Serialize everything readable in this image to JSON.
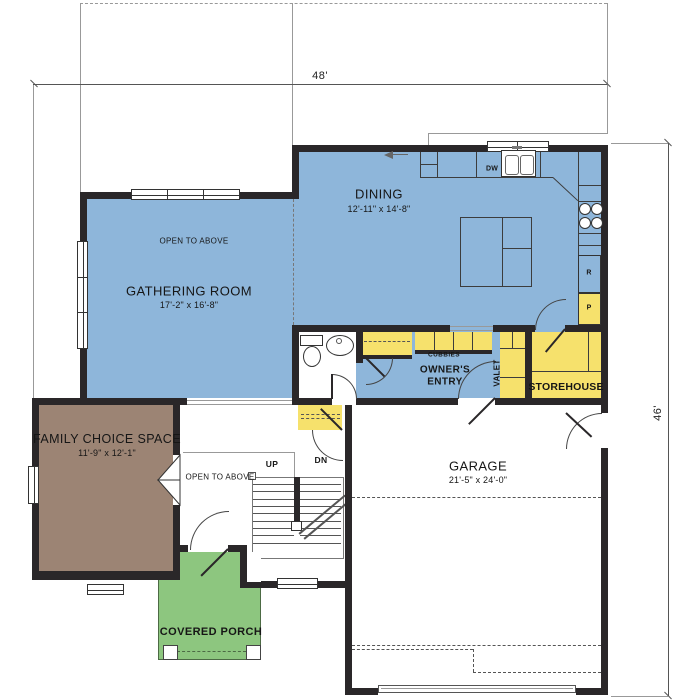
{
  "dimensions": {
    "overall_width": "48'",
    "overall_height": "46'"
  },
  "rooms": {
    "gathering_room": {
      "name": "GATHERING ROOM",
      "size": "17'-2\" x 16'-8\"",
      "note": "OPEN TO ABOVE"
    },
    "dining": {
      "name": "DINING",
      "size": "12'-11\" x 14'-8\""
    },
    "family_choice_space": {
      "name": "FAMILY CHOICE SPACE",
      "size": "11'-9\" x 12'-1\""
    },
    "garage": {
      "name": "GARAGE",
      "size": "21'-5\" x 24'-0\""
    },
    "covered_porch": {
      "name": "COVERED PORCH"
    },
    "owners_entry": {
      "name": "OWNER'S ENTRY"
    },
    "storehouse": {
      "name": "STOREHOUSE"
    },
    "valet": {
      "name": "VALET"
    },
    "cubbies": {
      "name": "CUBBIES"
    },
    "foyer": {
      "note": "OPEN TO ABOVE"
    }
  },
  "stairs": {
    "up": "UP",
    "down": "DN"
  },
  "appliances": {
    "dishwasher": "DW",
    "refrigerator": "R",
    "pantry": "P"
  },
  "colors": {
    "room_blue": "#8eb6da",
    "room_brown": "#9c8474",
    "porch_green": "#8dc67f",
    "cabinet_yellow": "#f6e16c",
    "wall": "#2a2729"
  }
}
